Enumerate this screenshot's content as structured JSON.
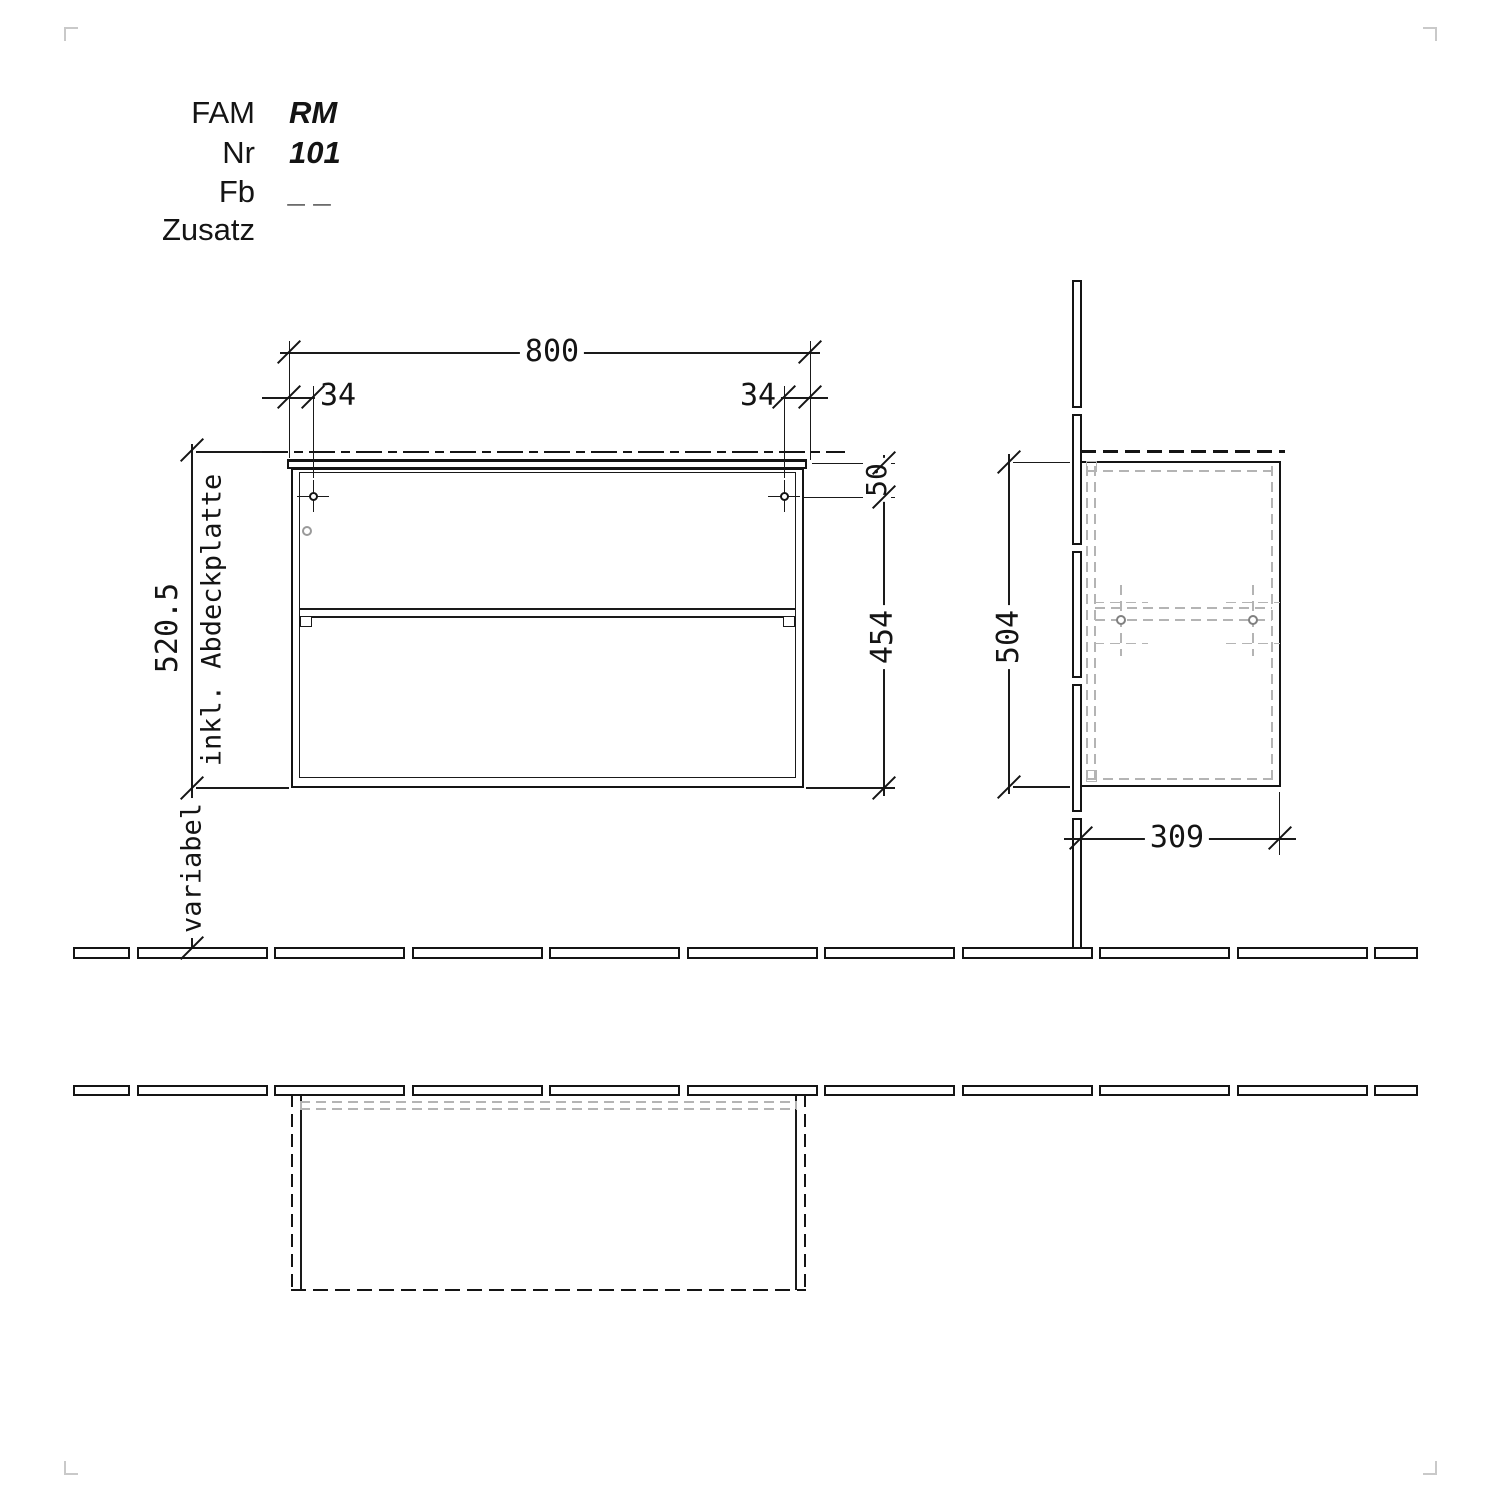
{
  "drawing": {
    "title_block": {
      "rows": [
        {
          "label": "FAM",
          "value": "RM"
        },
        {
          "label": "Nr",
          "value": "101"
        },
        {
          "label": "Fb",
          "value": "_ _"
        },
        {
          "label": "Zusatz",
          "value": ""
        }
      ]
    },
    "front_view": {
      "width": "800",
      "screw_offset_left": "34",
      "screw_offset_right": "34",
      "height_total": "520.5",
      "height_note": "inkl. Abdeckplatte",
      "height_below": "variabel",
      "top_offset": "50",
      "body_height": "454"
    },
    "side_view": {
      "height": "504",
      "depth": "309"
    }
  }
}
